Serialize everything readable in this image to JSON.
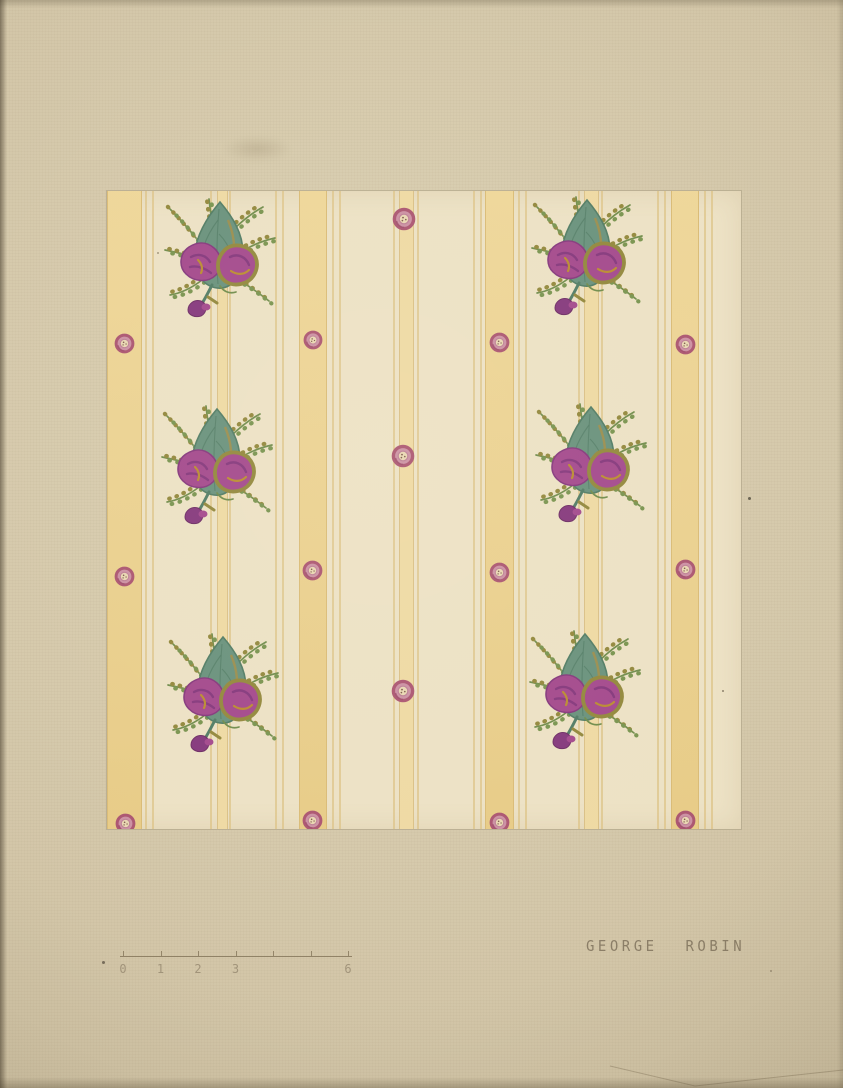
{
  "artwork": {
    "description": "Watercolor rendering of a striped floral wallpaper sample",
    "signature": "GEORGE ROBIN"
  },
  "palette": {
    "paper": "#d2c5a7",
    "paper_light": "#dacfb1",
    "paper_edge": "#b9ac8e",
    "sample_bg": "#ece1c4",
    "band_yellow": "#ecd18c",
    "band_edge": "#d9ba74",
    "narrow_yellow": "#eed9a2",
    "pinstripe": "#dcc182",
    "rosette_ring": "#aa536f",
    "rosette_mid": "#cb8fa2",
    "rosette_center": "#e9d7b2",
    "leaf_teal": "#67907b",
    "leaf_teal_dark": "#4f7a63",
    "olive": "#91863a",
    "magenta": "#a2468b",
    "purple_dark": "#83357b",
    "gold": "#b98a2e",
    "sprig_green": "#6e8a49",
    "pencil": "#9b8d74"
  },
  "sample": {
    "x": 106,
    "y": 190,
    "width": 634,
    "height": 638,
    "wide_bands": [
      {
        "x": 0,
        "w": 33
      },
      {
        "x": 192,
        "w": 26
      },
      {
        "x": 378,
        "w": 27
      },
      {
        "x": 564,
        "w": 26
      }
    ],
    "narrow_stripes": [
      {
        "x": 110,
        "w": 9
      },
      {
        "x": 292,
        "w": 13
      },
      {
        "x": 477,
        "w": 13
      }
    ],
    "pinstripes": [
      38,
      45,
      103,
      122,
      168,
      175,
      225,
      232,
      286,
      310,
      366,
      373,
      411,
      418,
      471,
      494,
      550,
      557,
      597,
      604
    ],
    "bouquet_size": 124,
    "bouquets": [
      {
        "x": 115,
        "y": 65
      },
      {
        "x": 112,
        "y": 272
      },
      {
        "x": 118,
        "y": 500
      },
      {
        "x": 482,
        "y": 63
      },
      {
        "x": 486,
        "y": 270
      },
      {
        "x": 480,
        "y": 497
      }
    ],
    "rosettes": [
      {
        "x": 297,
        "y": 28,
        "d": 24
      },
      {
        "x": 296,
        "y": 265,
        "d": 24
      },
      {
        "x": 296,
        "y": 500,
        "d": 24
      },
      {
        "x": 17,
        "y": 152,
        "d": 21
      },
      {
        "x": 206,
        "y": 149,
        "d": 20
      },
      {
        "x": 392,
        "y": 151,
        "d": 21
      },
      {
        "x": 578,
        "y": 153,
        "d": 21
      },
      {
        "x": 17,
        "y": 385,
        "d": 21
      },
      {
        "x": 205,
        "y": 379,
        "d": 21
      },
      {
        "x": 392,
        "y": 381,
        "d": 21
      },
      {
        "x": 578,
        "y": 378,
        "d": 21
      },
      {
        "x": 18,
        "y": 632,
        "d": 21
      },
      {
        "x": 205,
        "y": 629,
        "d": 21
      },
      {
        "x": 392,
        "y": 631,
        "d": 21
      },
      {
        "x": 578,
        "y": 629,
        "d": 21
      }
    ]
  },
  "ruler": {
    "x_line_start": 120,
    "x_line_end": 352,
    "y": 956,
    "x0": 123,
    "unit_px": 37.5,
    "tick_count": 7,
    "labels": [
      {
        "text": "0",
        "u": 0
      },
      {
        "text": "1",
        "u": 1
      },
      {
        "text": "2",
        "u": 2
      },
      {
        "text": "3",
        "u": 3
      },
      {
        "text": "6",
        "u": 6
      }
    ]
  },
  "signature": {
    "text": "GEORGE ROBIN",
    "x": 586,
    "y": 939
  },
  "specks": [
    {
      "x": 748,
      "y": 497,
      "s": 3,
      "c": "#4a4436"
    },
    {
      "x": 722,
      "y": 690,
      "s": 2,
      "c": "#6f6450"
    },
    {
      "x": 102,
      "y": 961,
      "s": 3,
      "c": "#5f5546"
    },
    {
      "x": 770,
      "y": 970,
      "s": 2,
      "c": "#8d8068"
    },
    {
      "x": 157,
      "y": 252,
      "s": 2,
      "c": "#8f8268"
    }
  ],
  "creases": [
    {
      "points": "610,1066 695,1086 843,1070"
    }
  ]
}
